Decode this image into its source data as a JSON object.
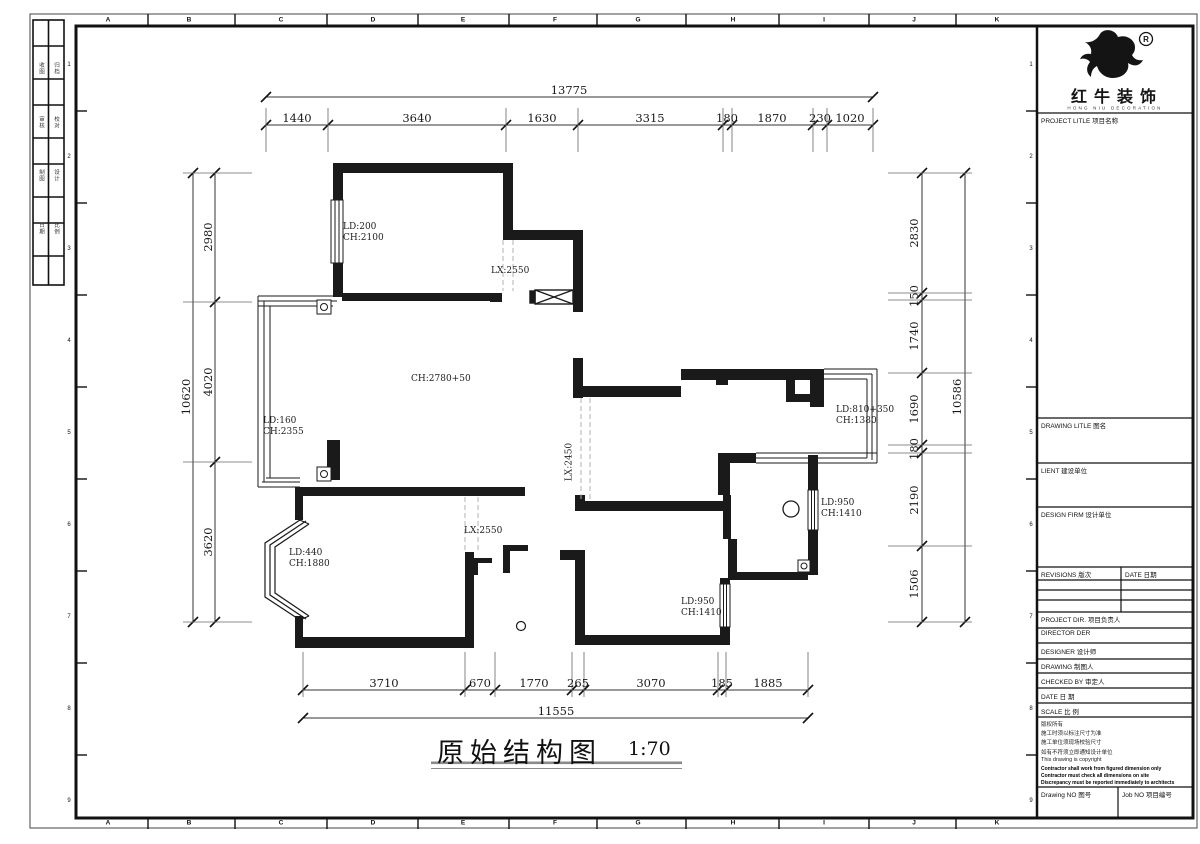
{
  "sheet": {
    "grid_letters": [
      "A",
      "B",
      "C",
      "D",
      "E",
      "F",
      "G",
      "H",
      "I",
      "J",
      "K"
    ],
    "grid_numbers": [
      "1",
      "2",
      "3",
      "4",
      "5",
      "6",
      "7",
      "8",
      "9"
    ],
    "corner_strip_rows": [
      [
        "收图",
        "归档"
      ],
      [
        "审核",
        "校对"
      ],
      [
        "制图",
        "设计"
      ],
      [
        "日期",
        "比例"
      ]
    ]
  },
  "logo": {
    "reg": "®",
    "name": "红牛装饰",
    "subtitle": "HONG NIU DECORATION"
  },
  "title_block": {
    "project_title": "PROJECT LITLE  项目名称",
    "drawing_title": "DRAWING LITLE  图名",
    "client": "LIENT  建设单位",
    "design_firm": "DESIGN FIRM  设计单位",
    "revisions": "REVISIONS  版次",
    "date_col": "DATE  日期",
    "project_dir": "PROJECT DIR.  项目负责人",
    "director": "DIRECTOR DER",
    "designer": "DESIGNER    设计师",
    "drawing_by": "DRAWING    制图人",
    "checked_by": "CHECKED BY    审定人",
    "date": "DATE    日  期",
    "scale": "SCALE    比  例",
    "copyright_lines": [
      "版权所有",
      "施工时须以标注尺寸为准",
      "施工单位须现场校验尺寸",
      "如有不符须立即通知设计单位",
      "This drawing is copyright"
    ],
    "copyright_bold_lines": [
      "Contractor shall work from figured dimension only",
      "Contractor must check all dimensions on site",
      "Discrepancy must be reported immediately to architects"
    ],
    "drawing_no": "Drawing NO  图号",
    "job_no": "Job NO  项目编号"
  },
  "plan": {
    "title": "原始结构图",
    "scale": "1:70",
    "room_labels": [
      {
        "lines": [
          "LD:200",
          "CH:2100"
        ]
      },
      {
        "lines": [
          "LX:2550"
        ]
      },
      {
        "lines": [
          "CH:2780+50"
        ]
      },
      {
        "lines": [
          "LD:160",
          "CH:2355"
        ]
      },
      {
        "lines": [
          "LX:2450"
        ]
      },
      {
        "lines": [
          "LD:810+350",
          "CH:1380"
        ]
      },
      {
        "lines": [
          "LD:950",
          "CH:1410"
        ]
      },
      {
        "lines": [
          "LD:440",
          "CH:1880"
        ]
      },
      {
        "lines": [
          "LX:2550"
        ]
      },
      {
        "lines": [
          "LD:950",
          "CH:1410"
        ]
      }
    ],
    "dimensions": {
      "top_total": "13775",
      "top_segments": [
        "1440",
        "3640",
        "1630",
        "3315",
        "180",
        "1870",
        "230",
        "1020"
      ],
      "bottom_total": "11555",
      "bottom_segments": [
        "3710",
        "670",
        "1770",
        "265",
        "3070",
        "185",
        "1885"
      ],
      "left_total": "10620",
      "left_segments": [
        "2980",
        "4020",
        "3620"
      ],
      "right_total": "10586",
      "right_segments": [
        "2830",
        "150",
        "1740",
        "1690",
        "180",
        "2190",
        "1506"
      ]
    }
  }
}
